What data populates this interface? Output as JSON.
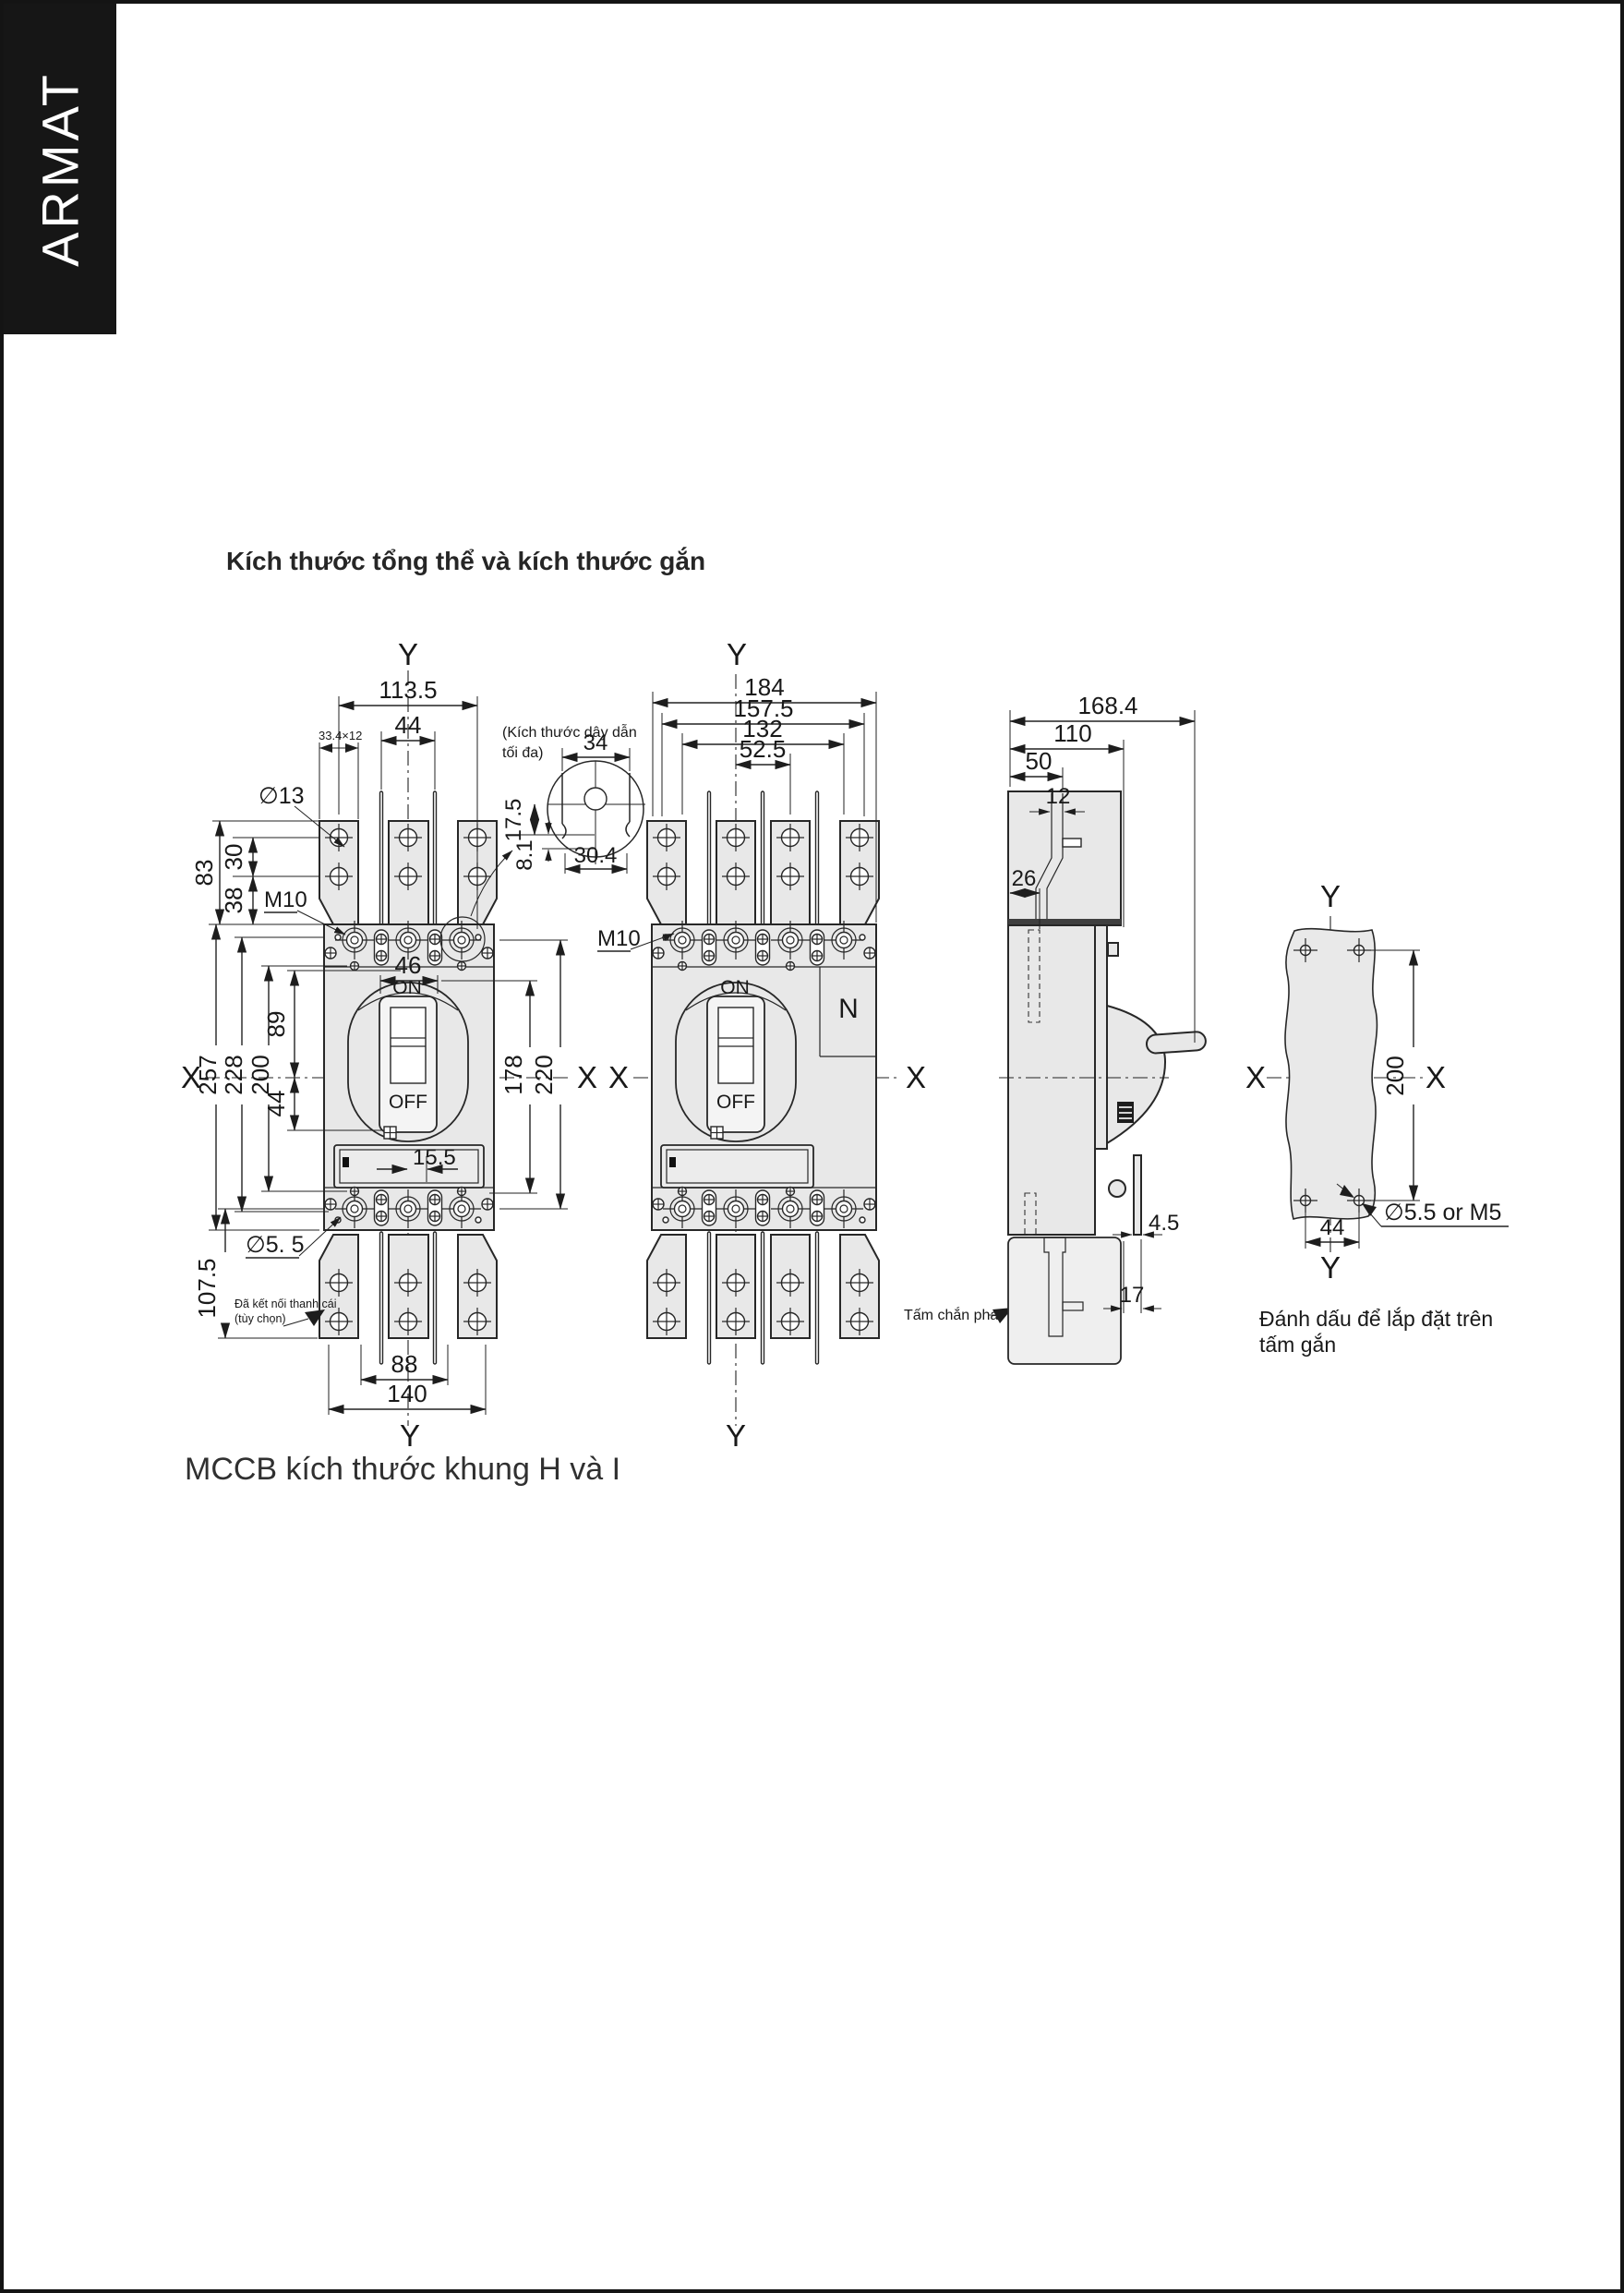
{
  "page": {
    "brand": "ARMAT",
    "title": "Kích thước tổng thể và kích thước gắn",
    "caption": "MCCB kích thước khung H và I"
  },
  "colors": {
    "banner_bg": "#161616",
    "ink": "#272727",
    "part_fill": "#e8e8e8"
  },
  "labels": {
    "axis_x": "X",
    "axis_y": "Y",
    "on": "ON",
    "off": "OFF",
    "neutral": "N",
    "thread": "M10",
    "lug_hole_dia": "∅13",
    "mount_hole_dia": "∅5. 5",
    "plate_hole_dia": "∅5.5 or M5",
    "slot_size": "33.4×12",
    "conductor_note_line1": "(Kích thước dây dẫn",
    "conductor_note_line2": "tối đa)",
    "busbar_note_line1": "Đã kết nối thanh cái",
    "busbar_note_line2": "(tùy chọn)",
    "phase_barrier": "Tấm chắn pha",
    "mounting_note_line1": "Đánh dấu để lắp đặt trên",
    "mounting_note_line2": "tấm gắn"
  },
  "dims": {
    "front3": {
      "top_width": "113.5",
      "pole_pitch": "44",
      "lug_height": "83",
      "hole_pitch": "30",
      "lug_to_base": "38",
      "handle_width": "46",
      "center_to_top": "89",
      "height_total": "257",
      "height_228": "228",
      "mount_pitch": "200",
      "handle_offset": "44",
      "right_178": "178",
      "right_220": "220",
      "window_offset": "15.5",
      "lug_ext": "107.5",
      "bottom_88": "88",
      "bottom_width": "140"
    },
    "detail": {
      "width": "34",
      "h1": "17.5",
      "h2": "8.1",
      "width2": "30.4"
    },
    "front4": {
      "overall": "184",
      "w157": "157.5",
      "w132": "132",
      "w52": "52.5"
    },
    "side": {
      "depth_total": "168.4",
      "depth_110": "110",
      "depth_50": "50",
      "bar_width": "12",
      "d26": "26",
      "t45": "4.5",
      "t17": "17"
    },
    "plate": {
      "mount_v": "200",
      "mount_h": "44"
    }
  }
}
